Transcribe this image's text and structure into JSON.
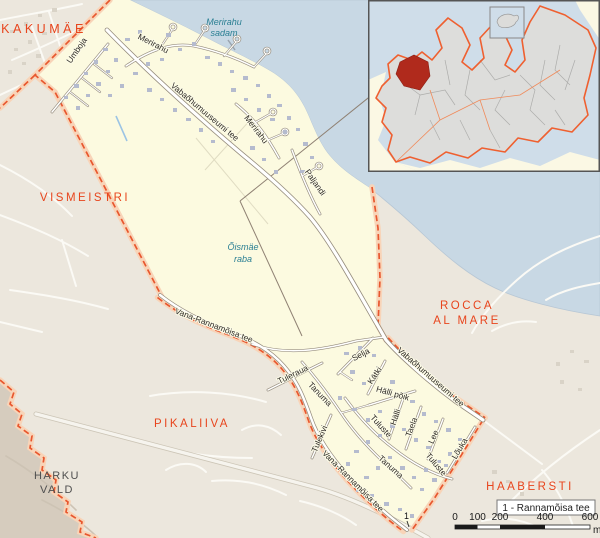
{
  "map": {
    "colors": {
      "boundary": "#e8572e",
      "district_fill": "#fcfae0",
      "sea": "#c8d8e4",
      "district_label": "#e8451d",
      "highlight_red": "#b02a1c"
    },
    "area_labels": [
      {
        "kind": "district-major",
        "text": "KAKUMÄE",
        "x": 44,
        "y": 33
      },
      {
        "kind": "district",
        "text": "VISMEISTRI",
        "x": 85,
        "y": 201
      },
      {
        "kind": "district",
        "text": "PIKALIIVA",
        "x": 192,
        "y": 427
      },
      {
        "kind": "district",
        "text": "ROCCA",
        "x": 467,
        "y": 309
      },
      {
        "kind": "district",
        "text": "AL MARE",
        "x": 467,
        "y": 324
      },
      {
        "kind": "district",
        "text": "HAABERSTI",
        "x": 530,
        "y": 490
      },
      {
        "kind": "municipality",
        "text": "HARKU",
        "x": 57,
        "y": 479
      },
      {
        "kind": "municipality",
        "text": "VALD",
        "x": 57,
        "y": 493
      },
      {
        "kind": "water",
        "text": "Merirahu",
        "x": 224,
        "y": 25
      },
      {
        "kind": "water",
        "text": "sadam",
        "x": 224,
        "y": 36
      },
      {
        "kind": "water",
        "text": "Õismäe",
        "x": 243,
        "y": 250
      },
      {
        "kind": "water",
        "text": "raba",
        "x": 243,
        "y": 262
      }
    ],
    "street_labels": [
      {
        "text": "Umboja",
        "x": 79,
        "y": 52,
        "rot": -55
      },
      {
        "text": "Merirahu",
        "x": 152,
        "y": 46,
        "rot": 27
      },
      {
        "text": "Vabaõhumuuseumi tee",
        "x": 203,
        "y": 114,
        "rot": 40
      },
      {
        "text": "Merirahu",
        "x": 254,
        "y": 131,
        "rot": 52
      },
      {
        "text": "Paljandi",
        "x": 313,
        "y": 184,
        "rot": 55
      },
      {
        "text": "Vana-Rannamõisa tee",
        "x": 213,
        "y": 328,
        "rot": 21
      },
      {
        "text": "Tuleraua",
        "x": 294,
        "y": 377,
        "rot": -26
      },
      {
        "text": "Tanuma",
        "x": 318,
        "y": 396,
        "rot": 46
      },
      {
        "text": "Selja",
        "x": 362,
        "y": 357,
        "rot": -27
      },
      {
        "text": "Kätki",
        "x": 377,
        "y": 377,
        "rot": -56
      },
      {
        "text": "Hälli põik",
        "x": 392,
        "y": 396,
        "rot": 16
      },
      {
        "text": "Hälli",
        "x": 398,
        "y": 418,
        "rot": -71
      },
      {
        "text": "Tuluste",
        "x": 379,
        "y": 428,
        "rot": 48
      },
      {
        "text": "Taela",
        "x": 414,
        "y": 428,
        "rot": -70
      },
      {
        "text": "Lee",
        "x": 436,
        "y": 438,
        "rot": -66
      },
      {
        "text": "Lõuka",
        "x": 462,
        "y": 450,
        "rot": -59
      },
      {
        "text": "Tulekivi",
        "x": 322,
        "y": 440,
        "rot": -67
      },
      {
        "text": "Tanuma",
        "x": 389,
        "y": 469,
        "rot": 42
      },
      {
        "text": "Tuluste",
        "x": 434,
        "y": 466,
        "rot": 50
      },
      {
        "text": "Vana-Rannamõisa tee",
        "x": 351,
        "y": 483,
        "rot": 45
      },
      {
        "text": "Vabaõhumuuseumi tee",
        "x": 429,
        "y": 379,
        "rot": 41
      }
    ],
    "legend": {
      "text": "1 - Rannamõisa tee"
    },
    "marker": {
      "text": "1"
    },
    "scalebar": {
      "ticks": [
        "0",
        "100",
        "200",
        "400",
        "600"
      ],
      "unit": "m"
    }
  }
}
